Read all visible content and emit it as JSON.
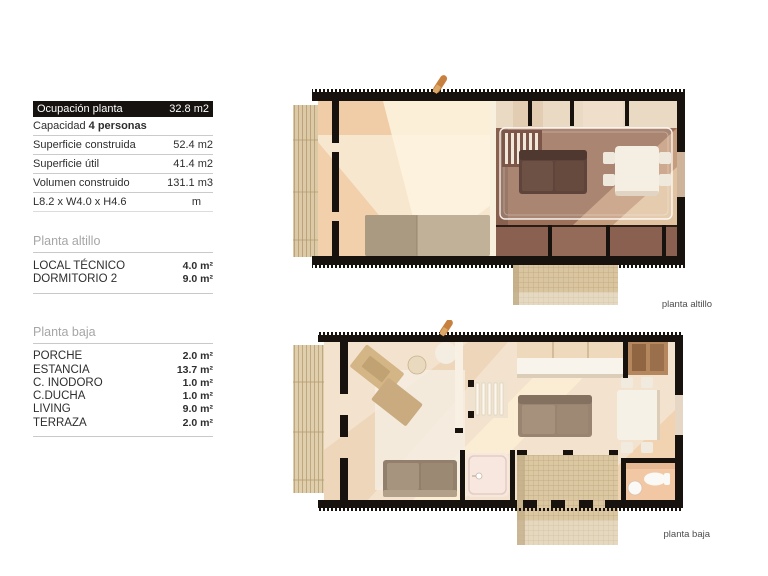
{
  "summary": {
    "header": {
      "label": "Ocupación planta",
      "value": "32.8 m2"
    },
    "capacity": {
      "label": "Capacidad ",
      "value": "4 personas"
    },
    "rows": [
      {
        "label": "Superficie construida",
        "value": "52.4 m2"
      },
      {
        "label": "Superficie útil",
        "value": "41.4 m2"
      },
      {
        "label": "Volumen construido",
        "value": "131.1 m3"
      },
      {
        "label": "L8.2 x W4.0 x H4.6",
        "value": "m"
      }
    ]
  },
  "sections": [
    {
      "title": "Planta altillo",
      "rows": [
        {
          "label": "LOCAL TÉCNICO",
          "value": "4.0 m²"
        },
        {
          "label": "DORMITORIO 2",
          "value": "9.0 m²"
        }
      ]
    },
    {
      "title": "Planta baja",
      "rows": [
        {
          "label": "PORCHE",
          "value": "2.0 m²"
        },
        {
          "label": "ESTANCIA",
          "value": "13.7 m²"
        },
        {
          "label": "C. INODORO",
          "value": "1.0 m²"
        },
        {
          "label": "C.DUCHA",
          "value": "1.0 m²"
        },
        {
          "label": "LIVING",
          "value": "9.0 m²"
        },
        {
          "label": "TERRAZA",
          "value": "2.0 m²"
        }
      ]
    }
  ],
  "plans": [
    {
      "label": "planta altillo"
    },
    {
      "label": "planta baja"
    }
  ],
  "colors": {
    "table_header_bg": "#151210",
    "wall_black": "#17120e",
    "deck_wood": "#dcc9a5",
    "floor_cream": "#f6e3c9",
    "void_brown": "#9c7059",
    "section_title_gray": "#a6a6a6"
  }
}
